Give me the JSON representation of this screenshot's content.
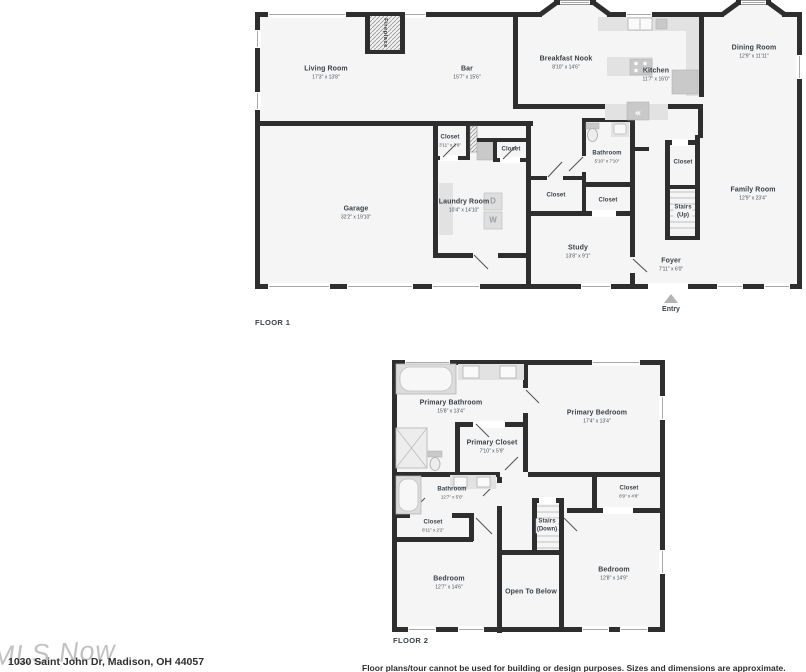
{
  "colors": {
    "wall": "#2e2e2e",
    "floor_fill": "#f5f5f5",
    "fixture_fill": "#e2e2e2",
    "label_text": "#39424a",
    "watermark": "#8f8f8f"
  },
  "icons": {
    "fridge_glyph": "«"
  },
  "floor1": {
    "label": "FLOOR 1",
    "rooms": {
      "living_room": {
        "name": "Living Room",
        "dims": "17'3\" x 13'8\""
      },
      "bar": {
        "name": "Bar",
        "dims": "15'7\" x 15'6\""
      },
      "breakfast_nook": {
        "name": "Breakfast Nook",
        "dims": "8'10\" x 14'6\""
      },
      "kitchen": {
        "name": "Kitchen",
        "dims": "11'7\" x 16'0\""
      },
      "dining_room": {
        "name": "Dining Room",
        "dims": "12'9\" x 11'11\""
      },
      "family_room": {
        "name": "Family Room",
        "dims": "12'9\" x 23'4\""
      },
      "garage": {
        "name": "Garage",
        "dims": "32'2\" x 19'10\""
      },
      "laundry_room": {
        "name": "Laundry Room",
        "dims": "10'4\" x 14'10\""
      },
      "study": {
        "name": "Study",
        "dims": "13'8\" x 9'1\""
      },
      "bathroom": {
        "name": "Bathroom",
        "dims": "5'10\" x 7'10\""
      },
      "foyer": {
        "name": "Foyer",
        "dims": "7'11\" x 6'0\""
      },
      "closet_hall": {
        "name": "Closet",
        "dims": "3'11\" x 2'8\""
      },
      "closet_small": {
        "name": "Closet"
      },
      "closet_hallway": {
        "name": "Closet"
      },
      "closet_study": {
        "name": "Closet"
      },
      "closet_stairs": {
        "name": "Closet"
      },
      "stairs": {
        "name": "Stairs",
        "sub": "(Up)"
      },
      "fireplace": {
        "name": "Fireplace"
      },
      "entry": {
        "name": "Entry"
      }
    },
    "appliances": {
      "dryer": "D",
      "washer": "W"
    }
  },
  "floor2": {
    "label": "FLOOR 2",
    "rooms": {
      "primary_bathroom": {
        "name": "Primary Bathroom",
        "dims": "15'8\" x 13'4\""
      },
      "primary_closet": {
        "name": "Primary Closet",
        "dims": "7'10\" x 5'9\""
      },
      "primary_bedroom": {
        "name": "Primary Bedroom",
        "dims": "17'4\" x 13'4\""
      },
      "bathroom": {
        "name": "Bathroom",
        "dims": "12'7\" x 5'0\""
      },
      "closet_hall": {
        "name": "Closet",
        "dims": "8'11\" x 2'2\""
      },
      "closet_bedroom": {
        "name": "Closet",
        "dims": "8'9\" x 4'8\""
      },
      "stairs": {
        "name": "Stairs",
        "sub": "(Down)"
      },
      "bedroom_left": {
        "name": "Bedroom",
        "dims": "12'7\" x 14'6\""
      },
      "open_to_below": {
        "name": "Open To Below"
      },
      "bedroom_right": {
        "name": "Bedroom",
        "dims": "12'8\" x 14'9\""
      }
    }
  },
  "footer": {
    "watermark": "MLS Now",
    "address": "1030 Saint John Dr, Madison, OH 44057",
    "disclaimer": "Floor plans/tour cannot be used for building or design purposes. Sizes and dimensions are approximate."
  }
}
